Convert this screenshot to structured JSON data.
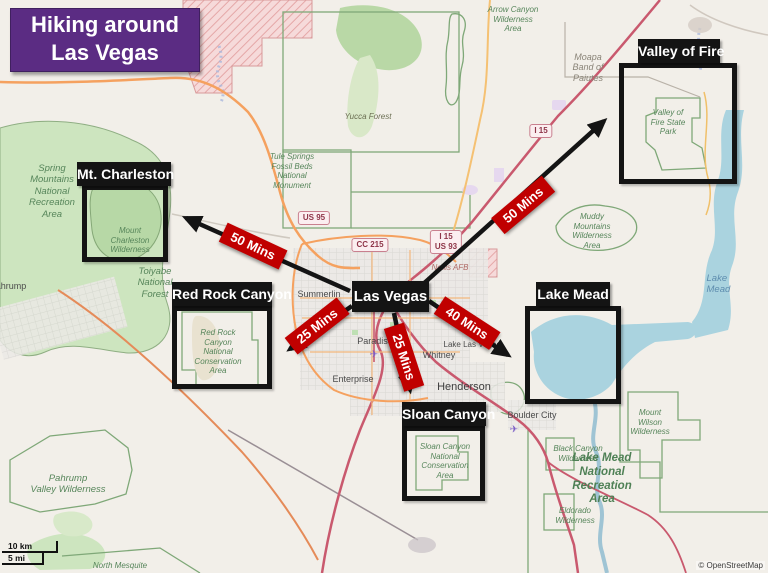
{
  "title": {
    "line1": "Hiking around",
    "line2": "Las Vegas"
  },
  "origin": {
    "label": "Las Vegas"
  },
  "destinations": [
    {
      "name": "Mt. Charleston",
      "drive_time": "50 Mins"
    },
    {
      "name": "Red Rock Canyon",
      "drive_time": "25 Mins"
    },
    {
      "name": "Sloan Canyon",
      "drive_time": "25 Mins"
    },
    {
      "name": "Lake Mead",
      "drive_time": "40 Mins"
    },
    {
      "name": "Valley of Fire",
      "drive_time": "50 Mins"
    }
  ],
  "road_shields": {
    "us95": "US 95",
    "cc215": "CC 215",
    "i15": "I 15",
    "i15_us93": "I 15\nUS 93"
  },
  "map_labels": {
    "protected_areas": {
      "arrow_canyon": "Arrow Canyon\nWilderness\nArea",
      "tule_springs": "Tule Springs\nFossil Beds\nNational\nMonument",
      "spring_mountains": "Spring\nMountains\nNational\nRecreation\nArea",
      "mount_charleston": "Mount\nCharleston\nWilderness",
      "toiyabe": "Toiyabe\nNational\nForest",
      "red_rock_nca": "Red Rock\nCanyon\nNational\nConservation\nArea",
      "muddy_mountains": "Muddy\nMountains\nWilderness\nArea",
      "sloan_nca": "Sloan Canyon\nNational\nConservation\nArea",
      "black_canyon": "Black Canyon\nWilderness",
      "lake_mead_nra": "Lake Mead\nNational\nRecreation\nArea",
      "eldorado": "Eldorado\nWilderness",
      "mount_wilson": "Mount\nWilson\nWilderness",
      "pahrump_valley": "Pahrump\nValley Wilderness",
      "north_mesquite": "North Mesquite",
      "valley_of_fire_park": "Valley of\nFire State\nPark",
      "yucca_forest": "Yucca Forest"
    },
    "places": {
      "pahrump": "Pahrump",
      "summerlin": "Summerlin",
      "paradise": "Paradise",
      "whitney": "Whitney",
      "enterprise": "Enterprise",
      "henderson": "Henderson",
      "boulder_city": "Boulder City",
      "nellis_afb": "Nellis AFB",
      "lake_las_vegas": "Lake Las Vegas",
      "moapa": "Moapa\nBand of\nPaiutes"
    },
    "water": {
      "lake_mead": "Lake Mead"
    }
  },
  "scale_bar": {
    "km": "10 km",
    "mi": "5 mi"
  },
  "attribution": "© OpenStreetMap",
  "colors": {
    "title_bg": "#5b2c83",
    "annotation_black": "#141414",
    "time_badge_red": "#c00000",
    "water_blue": "#aad3df",
    "forest_green": "#cde5bf"
  }
}
